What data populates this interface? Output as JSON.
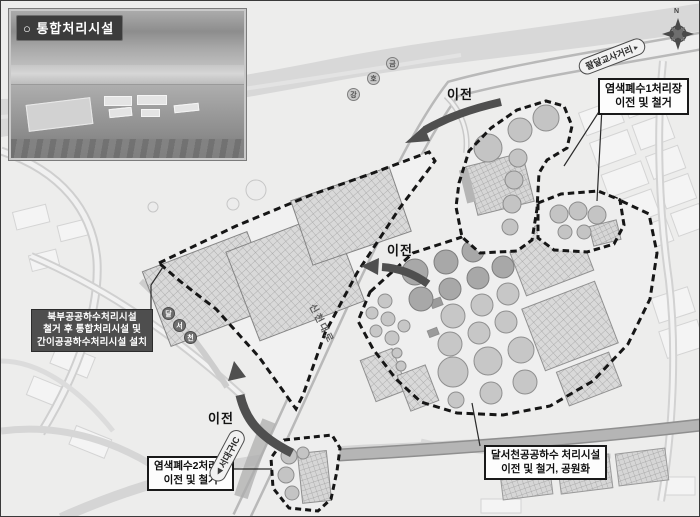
{
  "inset": {
    "title": "○ 통합처리시설"
  },
  "compass": {
    "north_label": "N"
  },
  "labels": {
    "relocate": "이전",
    "roads": {
      "sincheondaero": "신천대로",
      "paldal_intersection": "팔달교사거리",
      "seodaegu_ic": "서대구IC"
    },
    "river_name": "금호강",
    "river_chars": [
      "금",
      "호",
      "강"
    ],
    "stream_name": "달서천",
    "stream_chars": [
      "달",
      "서",
      "천"
    ]
  },
  "icons": {
    "capsule_arrow_right": "▸",
    "capsule_arrow_left": "◀"
  },
  "callouts": {
    "dye1": {
      "line1": "염색폐수1처리장",
      "line2": "이전 및 철거"
    },
    "bukbu": {
      "line1": "북부공공하수처리시설",
      "line2": "철거 후 통합처리시설 및",
      "line3": "간이공공하수처리시설 설치"
    },
    "dye2": {
      "line1": "염색폐수2처리장",
      "line2": "이전 및 철거"
    },
    "dalseo": {
      "line1": "달서천공공하수 처리시설",
      "line2": "이전 및 철거, 공원화"
    }
  },
  "colors": {
    "site_boundary": "#161616",
    "relocation_arrow": "#4f4f4f",
    "callout_dark_bg": "#4e4e4e",
    "river_fill": "#d8d8d8"
  }
}
